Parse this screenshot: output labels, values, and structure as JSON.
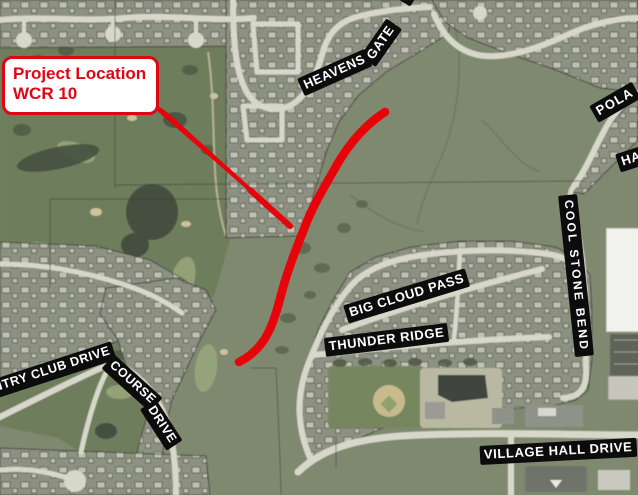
{
  "callout": {
    "line1": "Project Location",
    "line2": "WCR 10"
  },
  "street_labels": {
    "heavens_gate_part1": "HEAVENS",
    "heavens_gate_part2": "GATE",
    "top_edge_partial": "M",
    "polaris_partial": "POLA",
    "ha_partial": "HA",
    "cool_stone_bend": "COOL STONE BEND",
    "big_cloud_pass": "BIG CLOUD PASS",
    "thunder_ridge": "THUNDER RIDGE",
    "village_hall_drive": "VILLAGE HALL DRIVE",
    "country_club_drive_partial": "NTRY CLUB DRIVE",
    "course_drive_part1": "COURSE",
    "course_drive_part2": "DRIVE"
  },
  "colors": {
    "route": "#e8030a",
    "callout_border": "#de0712",
    "callout_text": "#de0712",
    "label_background": "#0c0c0c",
    "label_text": "#ffffff"
  }
}
